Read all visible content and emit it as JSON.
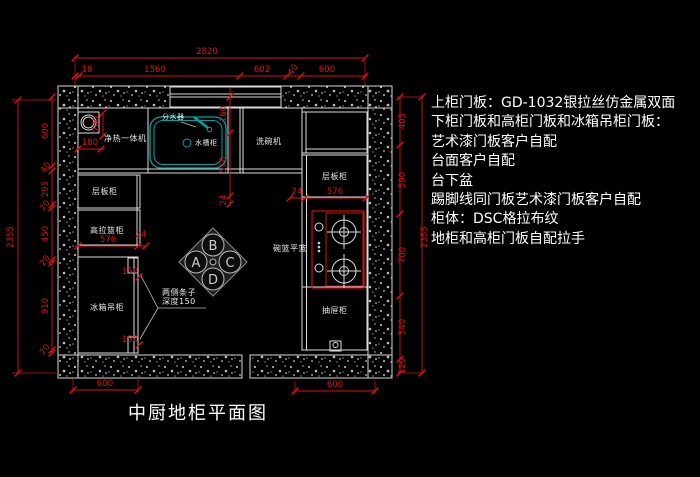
{
  "title": "中厨地柜平面图",
  "notes": [
    "上柜门板：GD-1032银拉丝仿金属双面",
    "下柜门板和高柜门板和冰箱吊柜门板：",
    "艺术漆门板客户自配",
    "台面客户自配",
    "台下盆",
    "踢脚线同门板艺术漆门板客户自配",
    "柜体：DSC格拉布纹",
    "地柜和高柜门板自配拉手"
  ],
  "labels": {
    "water_purifier": "净热一体机",
    "water_distributor": "分水器",
    "sink_cabinet": "水槽柜",
    "dishwasher": "洗碗机",
    "shelf_cabinet_left": "层板柜",
    "tall_basket_cabinet": "高拉篮柜",
    "fridge_wall_cabinet": "冰箱吊柜",
    "shelf_cabinet_right": "层板柜",
    "bowl_basket": "碗篮平篮",
    "drawer_cabinet": "抽屉柜",
    "side_strips_line1": "两侧条子",
    "side_strips_line2": "深度150"
  },
  "compass": [
    "A",
    "B",
    "C",
    "D"
  ],
  "dimensions": {
    "top_total": "2820",
    "top_chain": [
      "18",
      "1560",
      "602",
      "40",
      "600"
    ],
    "left_total": "2355",
    "left_chain": [
      "600",
      "40",
      "295",
      "20",
      "450",
      "20",
      "910",
      "20"
    ],
    "right_total": "2355",
    "right_chain": [
      "405",
      "590",
      "700",
      "540",
      "120"
    ],
    "sink_chain": [
      "160",
      "576",
      "24"
    ],
    "purifier_depth": "200",
    "purifier_width": "180",
    "left_cab": [
      "576",
      "24"
    ],
    "right_cab": [
      "24",
      "576"
    ],
    "strip_top": "150",
    "strip_bottom": "150",
    "bottom_left": "600",
    "bottom_right": "600"
  },
  "colors": {
    "dim": "#d81414",
    "line": "#dcdcdc",
    "sink": "#00a3a3",
    "stove": "#cf1212",
    "text": "#ffffff"
  }
}
